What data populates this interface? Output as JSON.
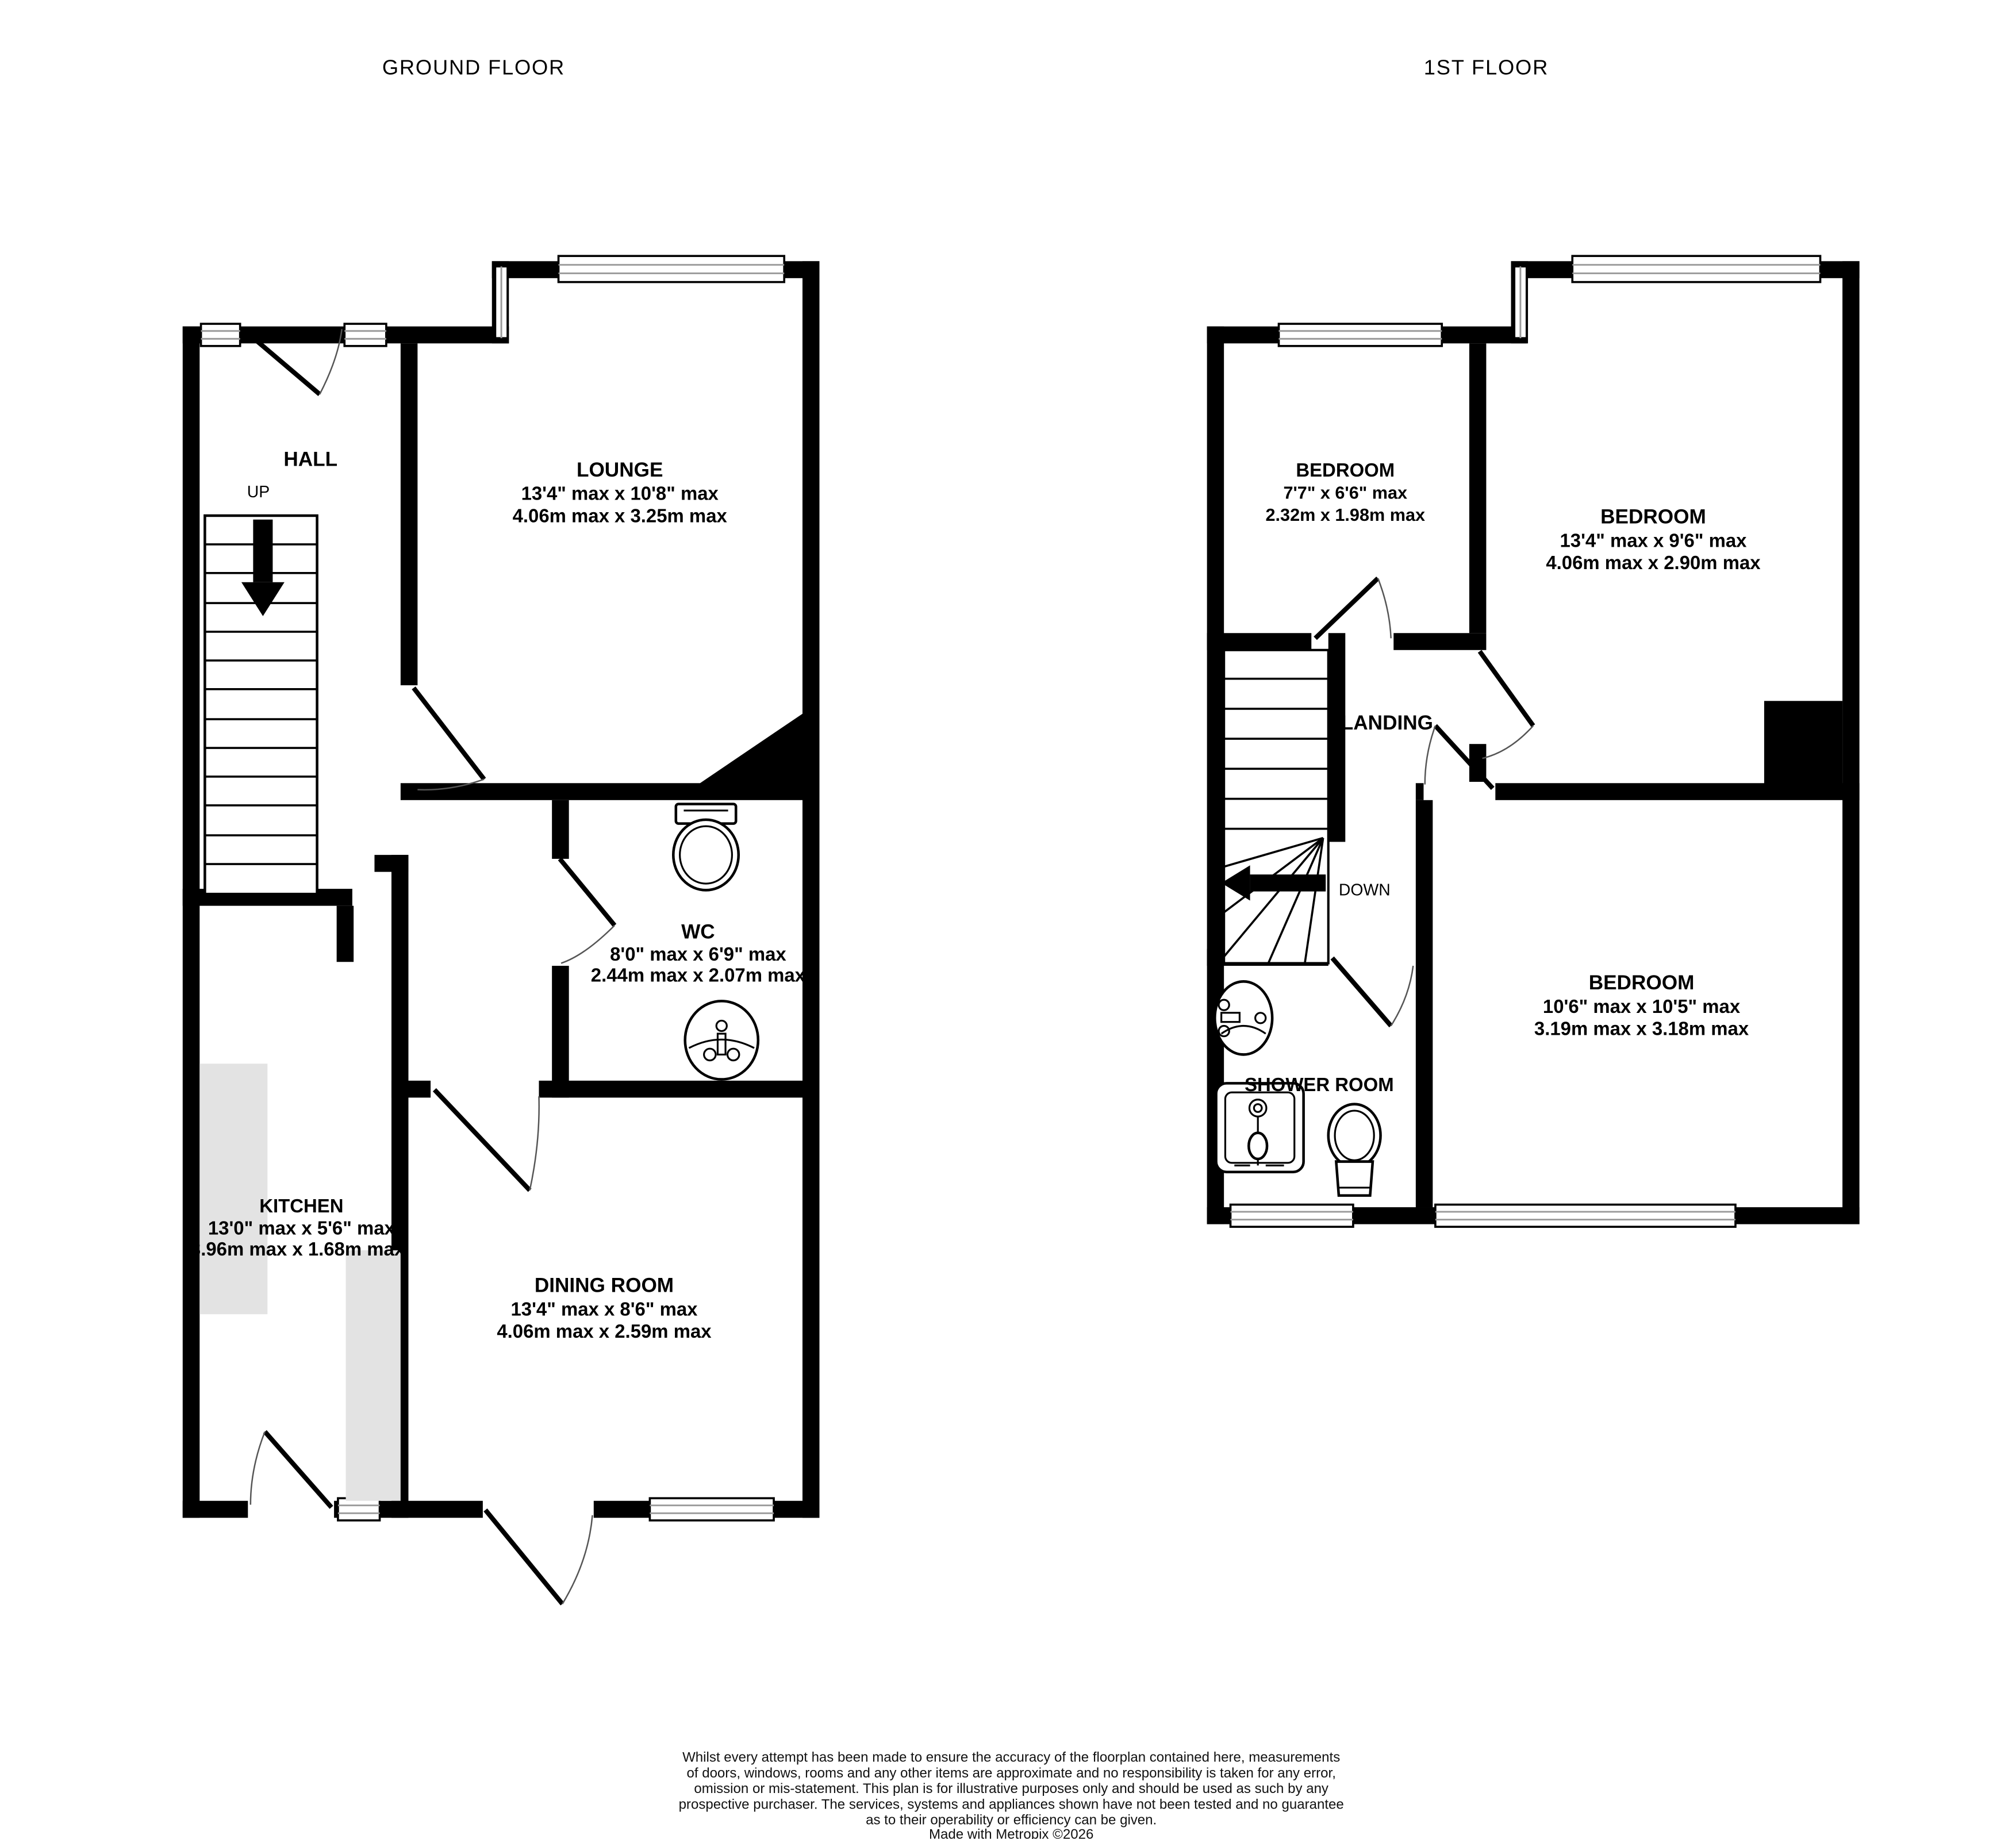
{
  "titles": {
    "ground": "GROUND FLOOR",
    "first": "1ST FLOOR"
  },
  "ground_floor": {
    "hall": {
      "name": "HALL",
      "up_label": "UP"
    },
    "lounge": {
      "name": "LOUNGE",
      "dims_imperial": "13'4\" max x 10'8\" max",
      "dims_metric": "4.06m max x 3.25m max"
    },
    "wc": {
      "name": "WC",
      "dims_imperial": "8'0\" max x 6'9\" max",
      "dims_metric": "2.44m max x 2.07m max"
    },
    "kitchen": {
      "name": "KITCHEN",
      "dims_imperial": "13'0\" max x 5'6\" max",
      "dims_metric": "3.96m max x 1.68m max"
    },
    "dining": {
      "name": "DINING ROOM",
      "dims_imperial": "13'4\" max x 8'6\" max",
      "dims_metric": "4.06m max x 2.59m max"
    }
  },
  "first_floor": {
    "bedroom_small": {
      "name": "BEDROOM",
      "dims_imperial": "7'7\"  x 6'6\" max",
      "dims_metric": "2.32m  x 1.98m max"
    },
    "bedroom_front": {
      "name": "BEDROOM",
      "dims_imperial": "13'4\" max x 9'6\" max",
      "dims_metric": "4.06m max x 2.90m max"
    },
    "bedroom_back": {
      "name": "BEDROOM",
      "dims_imperial": "10'6\" max x 10'5\" max",
      "dims_metric": "3.19m max x 3.18m max"
    },
    "landing": {
      "name": "LANDING",
      "down_label": "DOWN"
    },
    "shower_room": {
      "name": "SHOWER ROOM"
    }
  },
  "footer": {
    "disclaimer": [
      "Whilst every attempt has been made to ensure the accuracy of the floorplan contained here, measurements",
      "of doors, windows, rooms and any other items are approximate and no responsibility is taken for any error,",
      "omission or mis-statement. This plan is for illustrative purposes only and should be used as such by any",
      "prospective purchaser. The services, systems and appliances shown have not been tested and no guarantee",
      "as to their operability or efficiency can be given."
    ],
    "credit": "Made with Metropix ©2026"
  },
  "colors": {
    "wall": "#000000",
    "counter": "#e3e3e3",
    "window_line": "#9a9a9a",
    "background": "#ffffff"
  }
}
